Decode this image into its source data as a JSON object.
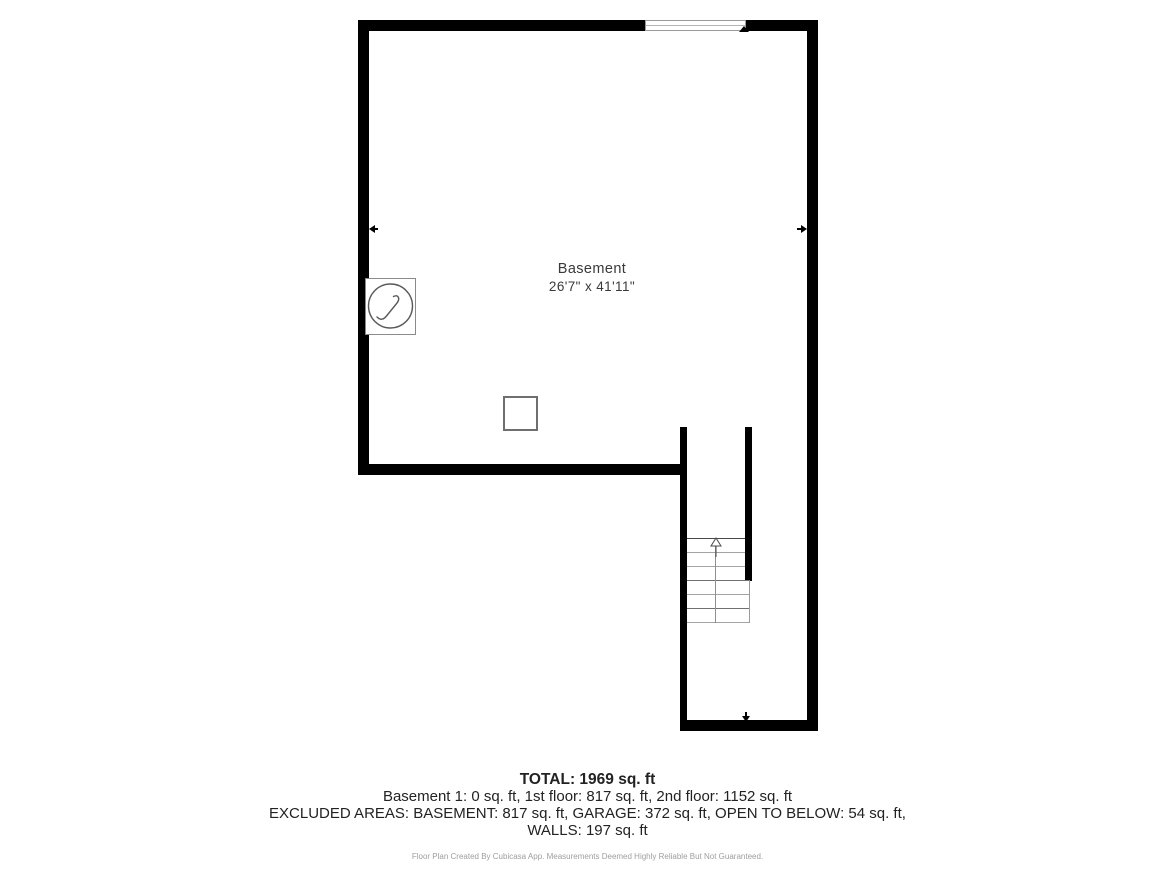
{
  "floor_plan": {
    "room": {
      "name": "Basement",
      "dimensions": "26'7\" x 41'11\""
    },
    "features": {
      "window": "window-on-top-wall",
      "electrical_panel": "circle-lightning-symbol",
      "support_post": "small-square",
      "staircase": "stairs-going-up"
    },
    "colors": {
      "walls": "#000000",
      "thin_lines": "#9a9a9a",
      "room_text": "#3a3a3a",
      "summary_text": "#222222",
      "footer_text": "#9e9e9e"
    }
  },
  "summary": {
    "total": "TOTAL: 1969 sq. ft",
    "floor_breakdown": "Basement 1: 0 sq. ft, 1st floor: 817 sq. ft, 2nd floor: 1152 sq. ft",
    "excluded_areas": "EXCLUDED AREAS: BASEMENT: 817 sq. ft, GARAGE: 372 sq. ft, OPEN TO BELOW: 54 sq. ft,",
    "walls": "WALLS: 197 sq. ft"
  },
  "footer": {
    "disclaimer": "Floor Plan Created By Cubicasa App. Measurements Deemed Highly Reliable But Not Guaranteed."
  }
}
